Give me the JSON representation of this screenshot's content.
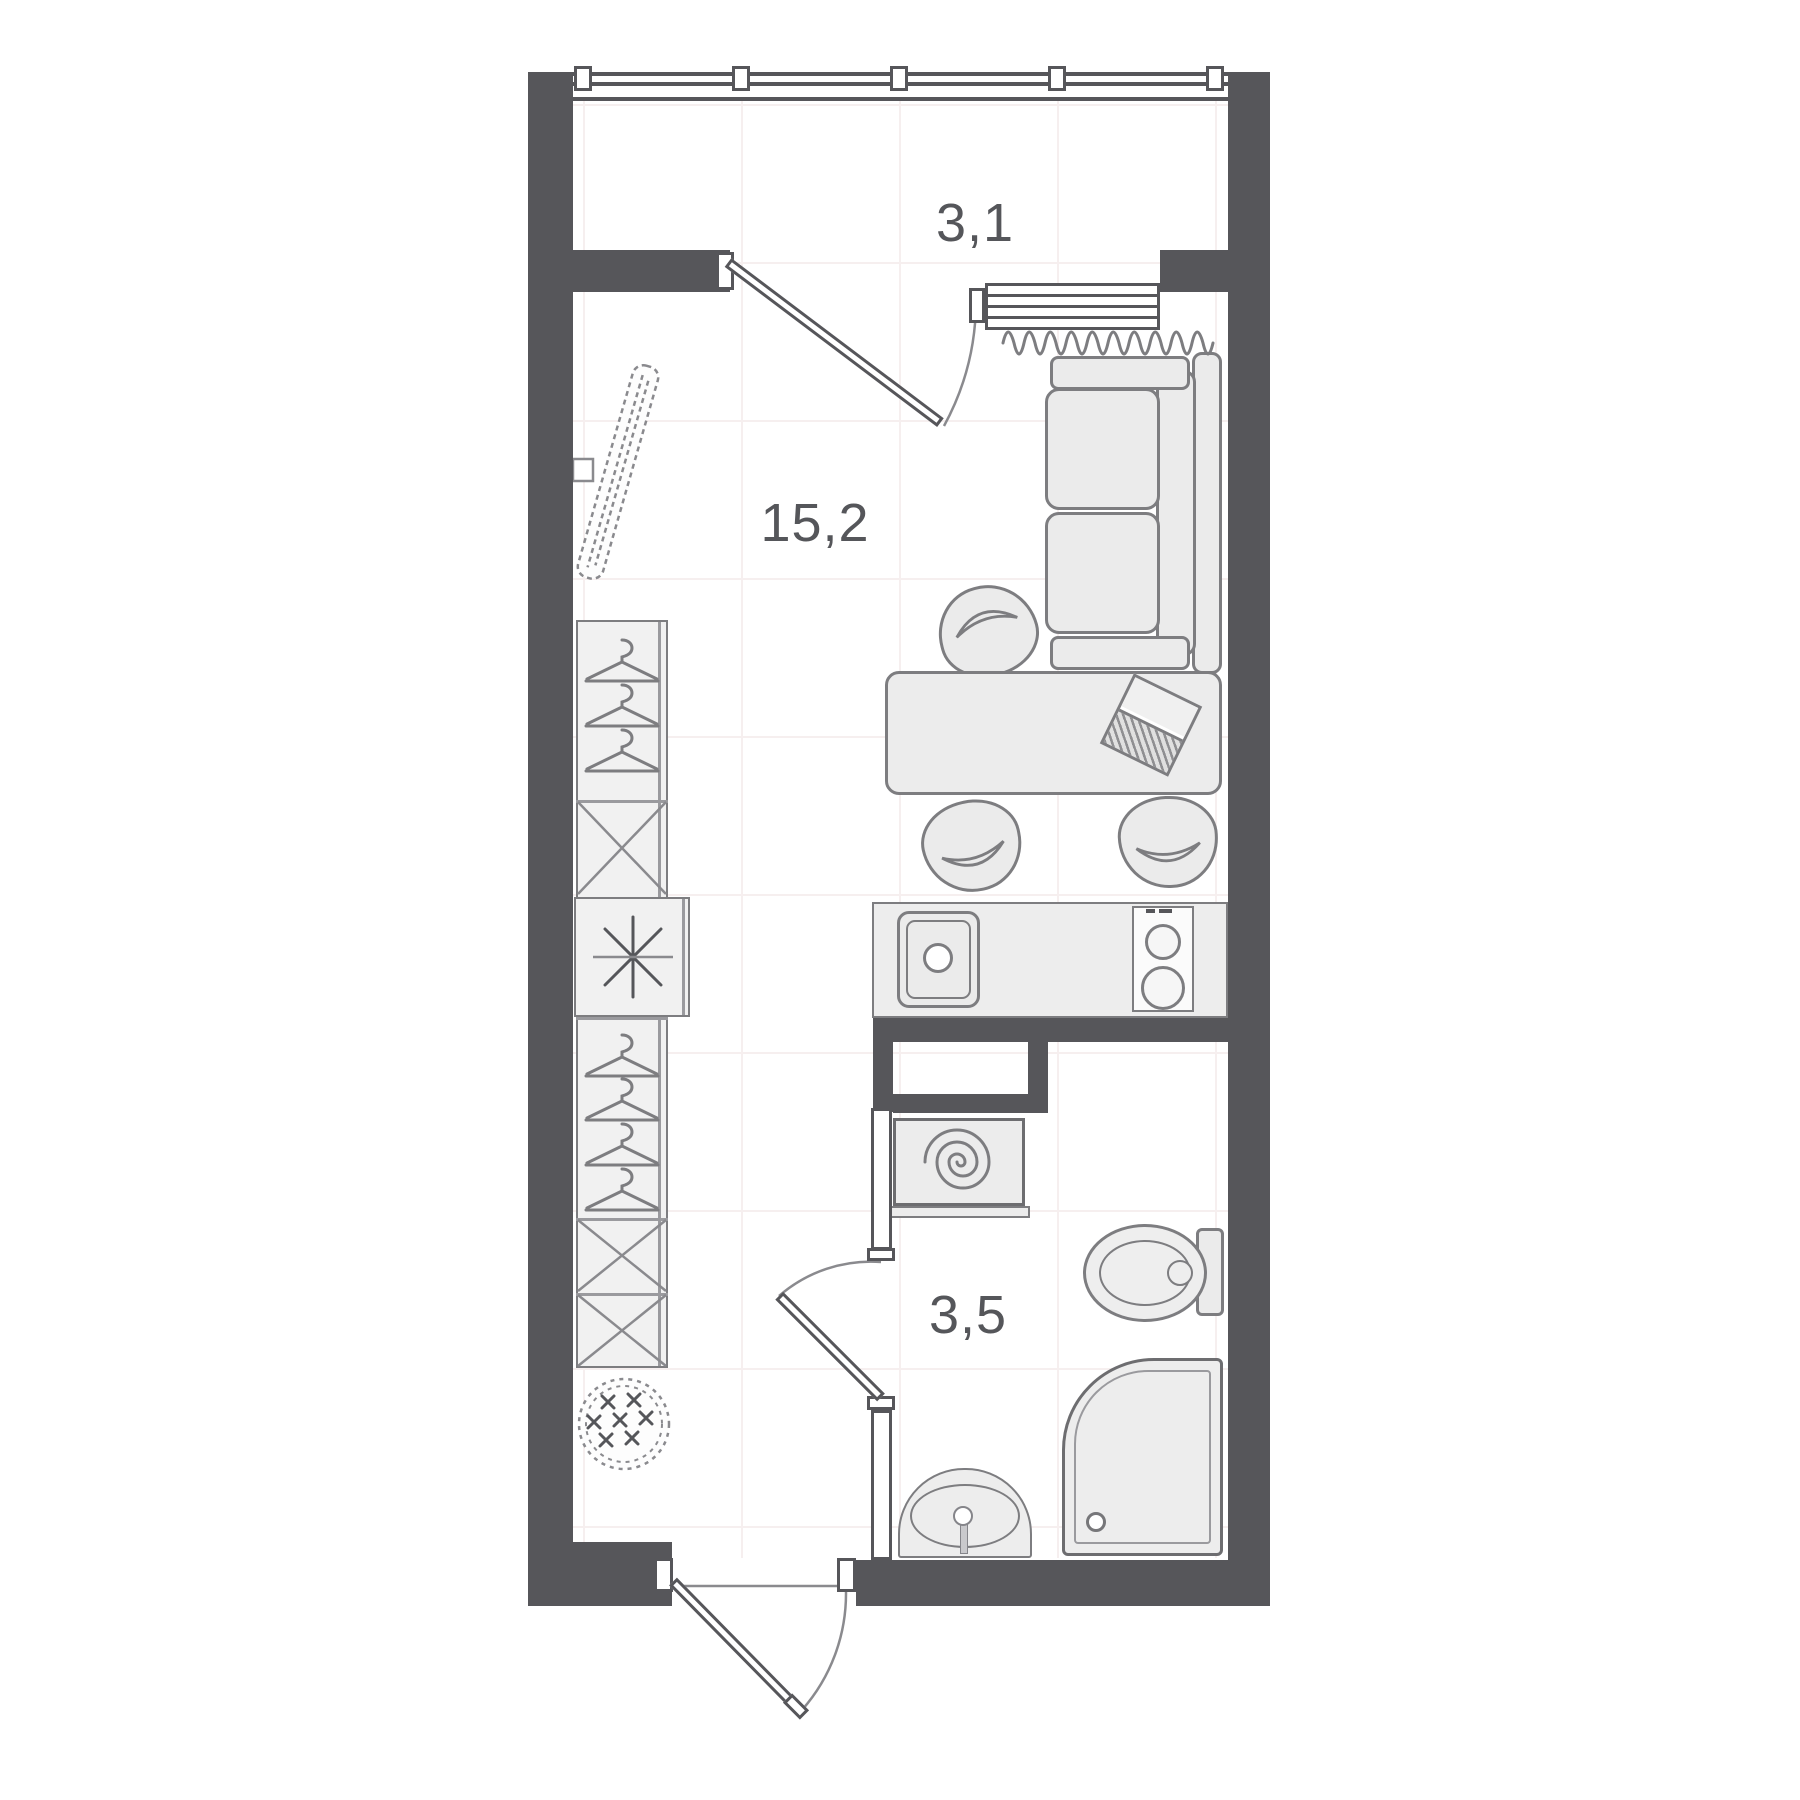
{
  "plan": {
    "type": "apartment-floor-plan",
    "areas": {
      "balcony": "3,1",
      "living_room": "15,2",
      "bathroom": "3,5"
    },
    "colors": {
      "wall": "#56565a",
      "furniture_fill": "#ebebeb",
      "line": "#7d7d80",
      "label": "#55565a",
      "grid": "#f6efef",
      "background": "#ffffff"
    },
    "fixtures": [
      "window-band",
      "balcony-door",
      "window-sill",
      "radiator",
      "sofa",
      "dining-table",
      "chairs",
      "laptop",
      "kitchen-counter",
      "kitchen-sink",
      "stove",
      "wardrobe",
      "hangers",
      "fridge",
      "mirror",
      "pouf",
      "washing-machine",
      "toilet",
      "shower",
      "bathroom-sink",
      "bathroom-door",
      "entry-door"
    ]
  }
}
